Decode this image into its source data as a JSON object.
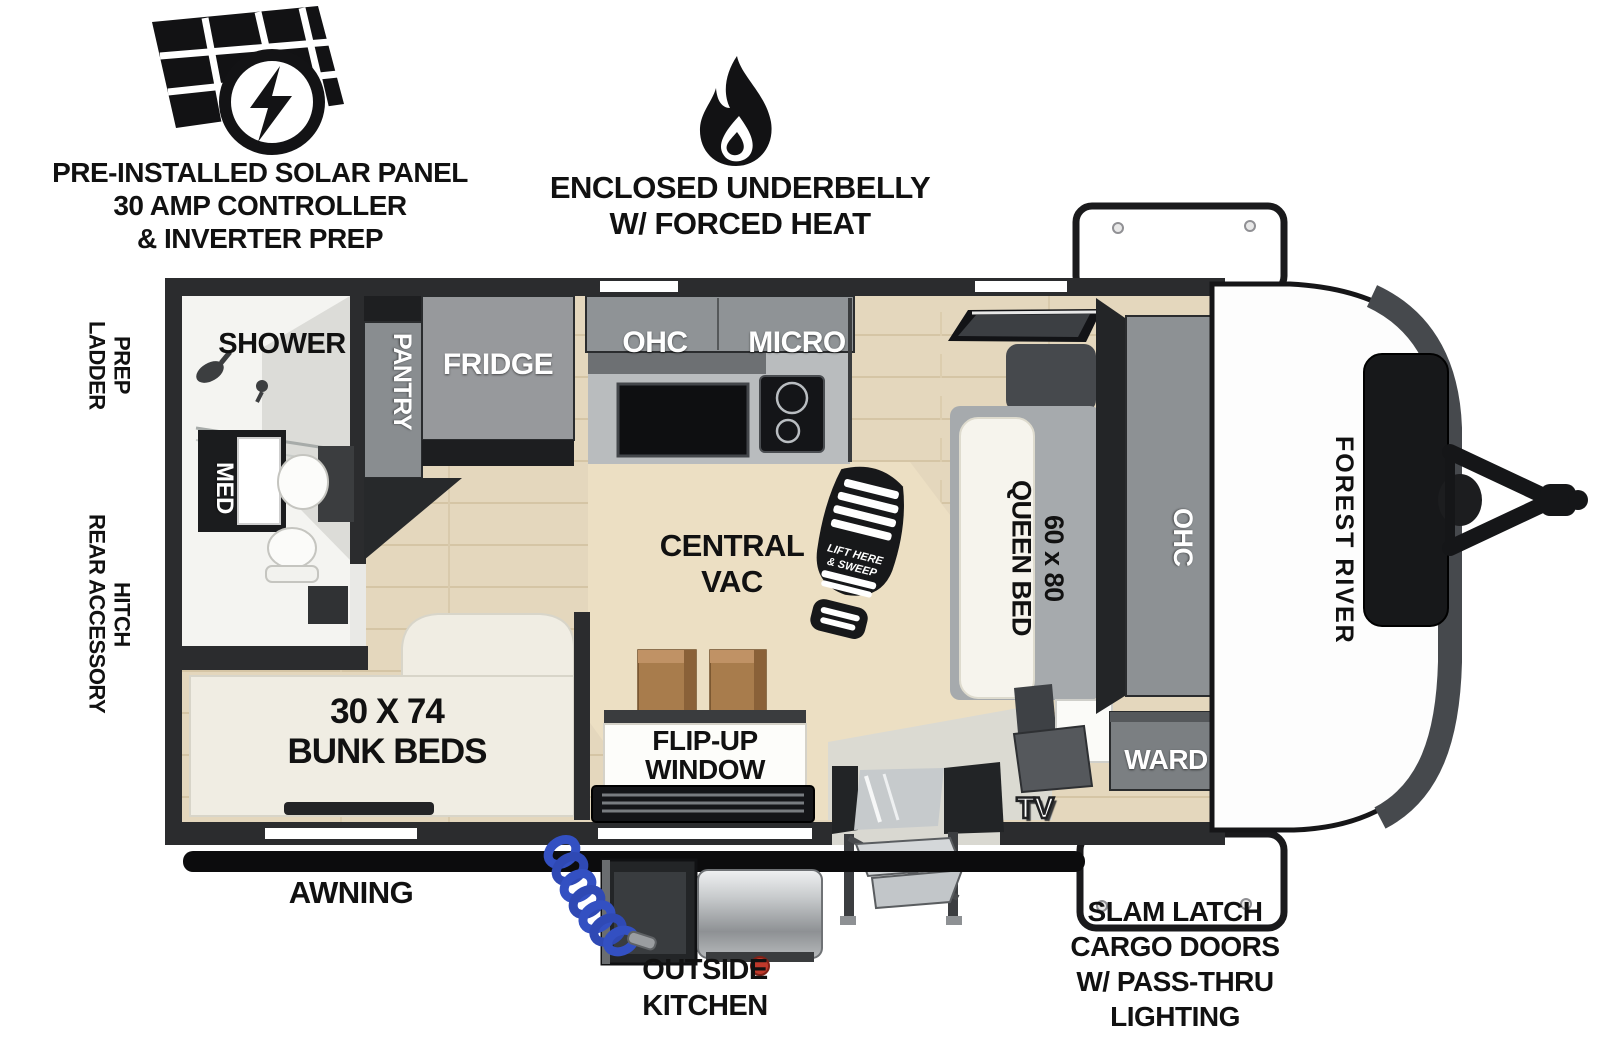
{
  "callouts": {
    "solar": "PRE-INSTALLED SOLAR PANEL\n30 AMP CONTROLLER\n& INVERTER PREP",
    "underbelly": "ENCLOSED UNDERBELLY\nW/ FORCED HEAT",
    "ladder_prep": "LADDER\nPREP",
    "rear_accessory_hitch": "REAR ACCESSORY\nHITCH",
    "awning": "AWNING",
    "outside_kitchen": "OUTSIDE\nKITCHEN",
    "slam_latch": "SLAM LATCH\nCARGO DOORS\nW/ PASS-THRU\nLIGHTING"
  },
  "floorplan": {
    "brand": "FOREST RIVER",
    "shower": "SHOWER",
    "med": "MED",
    "pantry": "PANTRY",
    "fridge": "FRIDGE",
    "ohc_kitchen": "OHC",
    "micro": "MICRO",
    "central_vac": "CENTRAL\nVAC",
    "queen_bed": "60 x 80\nQUEEN BED",
    "ohc_bedroom": "OHC",
    "ward": "WARD",
    "tv": "TV",
    "flip_up_window": "FLIP-UP\nWINDOW",
    "bunk_beds": "30 X 74\nBUNK BEDS",
    "boot_line1": "LIFT HERE",
    "boot_line2": "& SWEEP"
  },
  "colors": {
    "wall": "#2b2c2e",
    "floor": "#e4d7bd",
    "cabinet_gray": "#8f9396",
    "bath_white": "#f4f4f1",
    "hose_blue": "#3350c2",
    "ink_black": "#121214",
    "stool_brown": "#a87c4c"
  }
}
